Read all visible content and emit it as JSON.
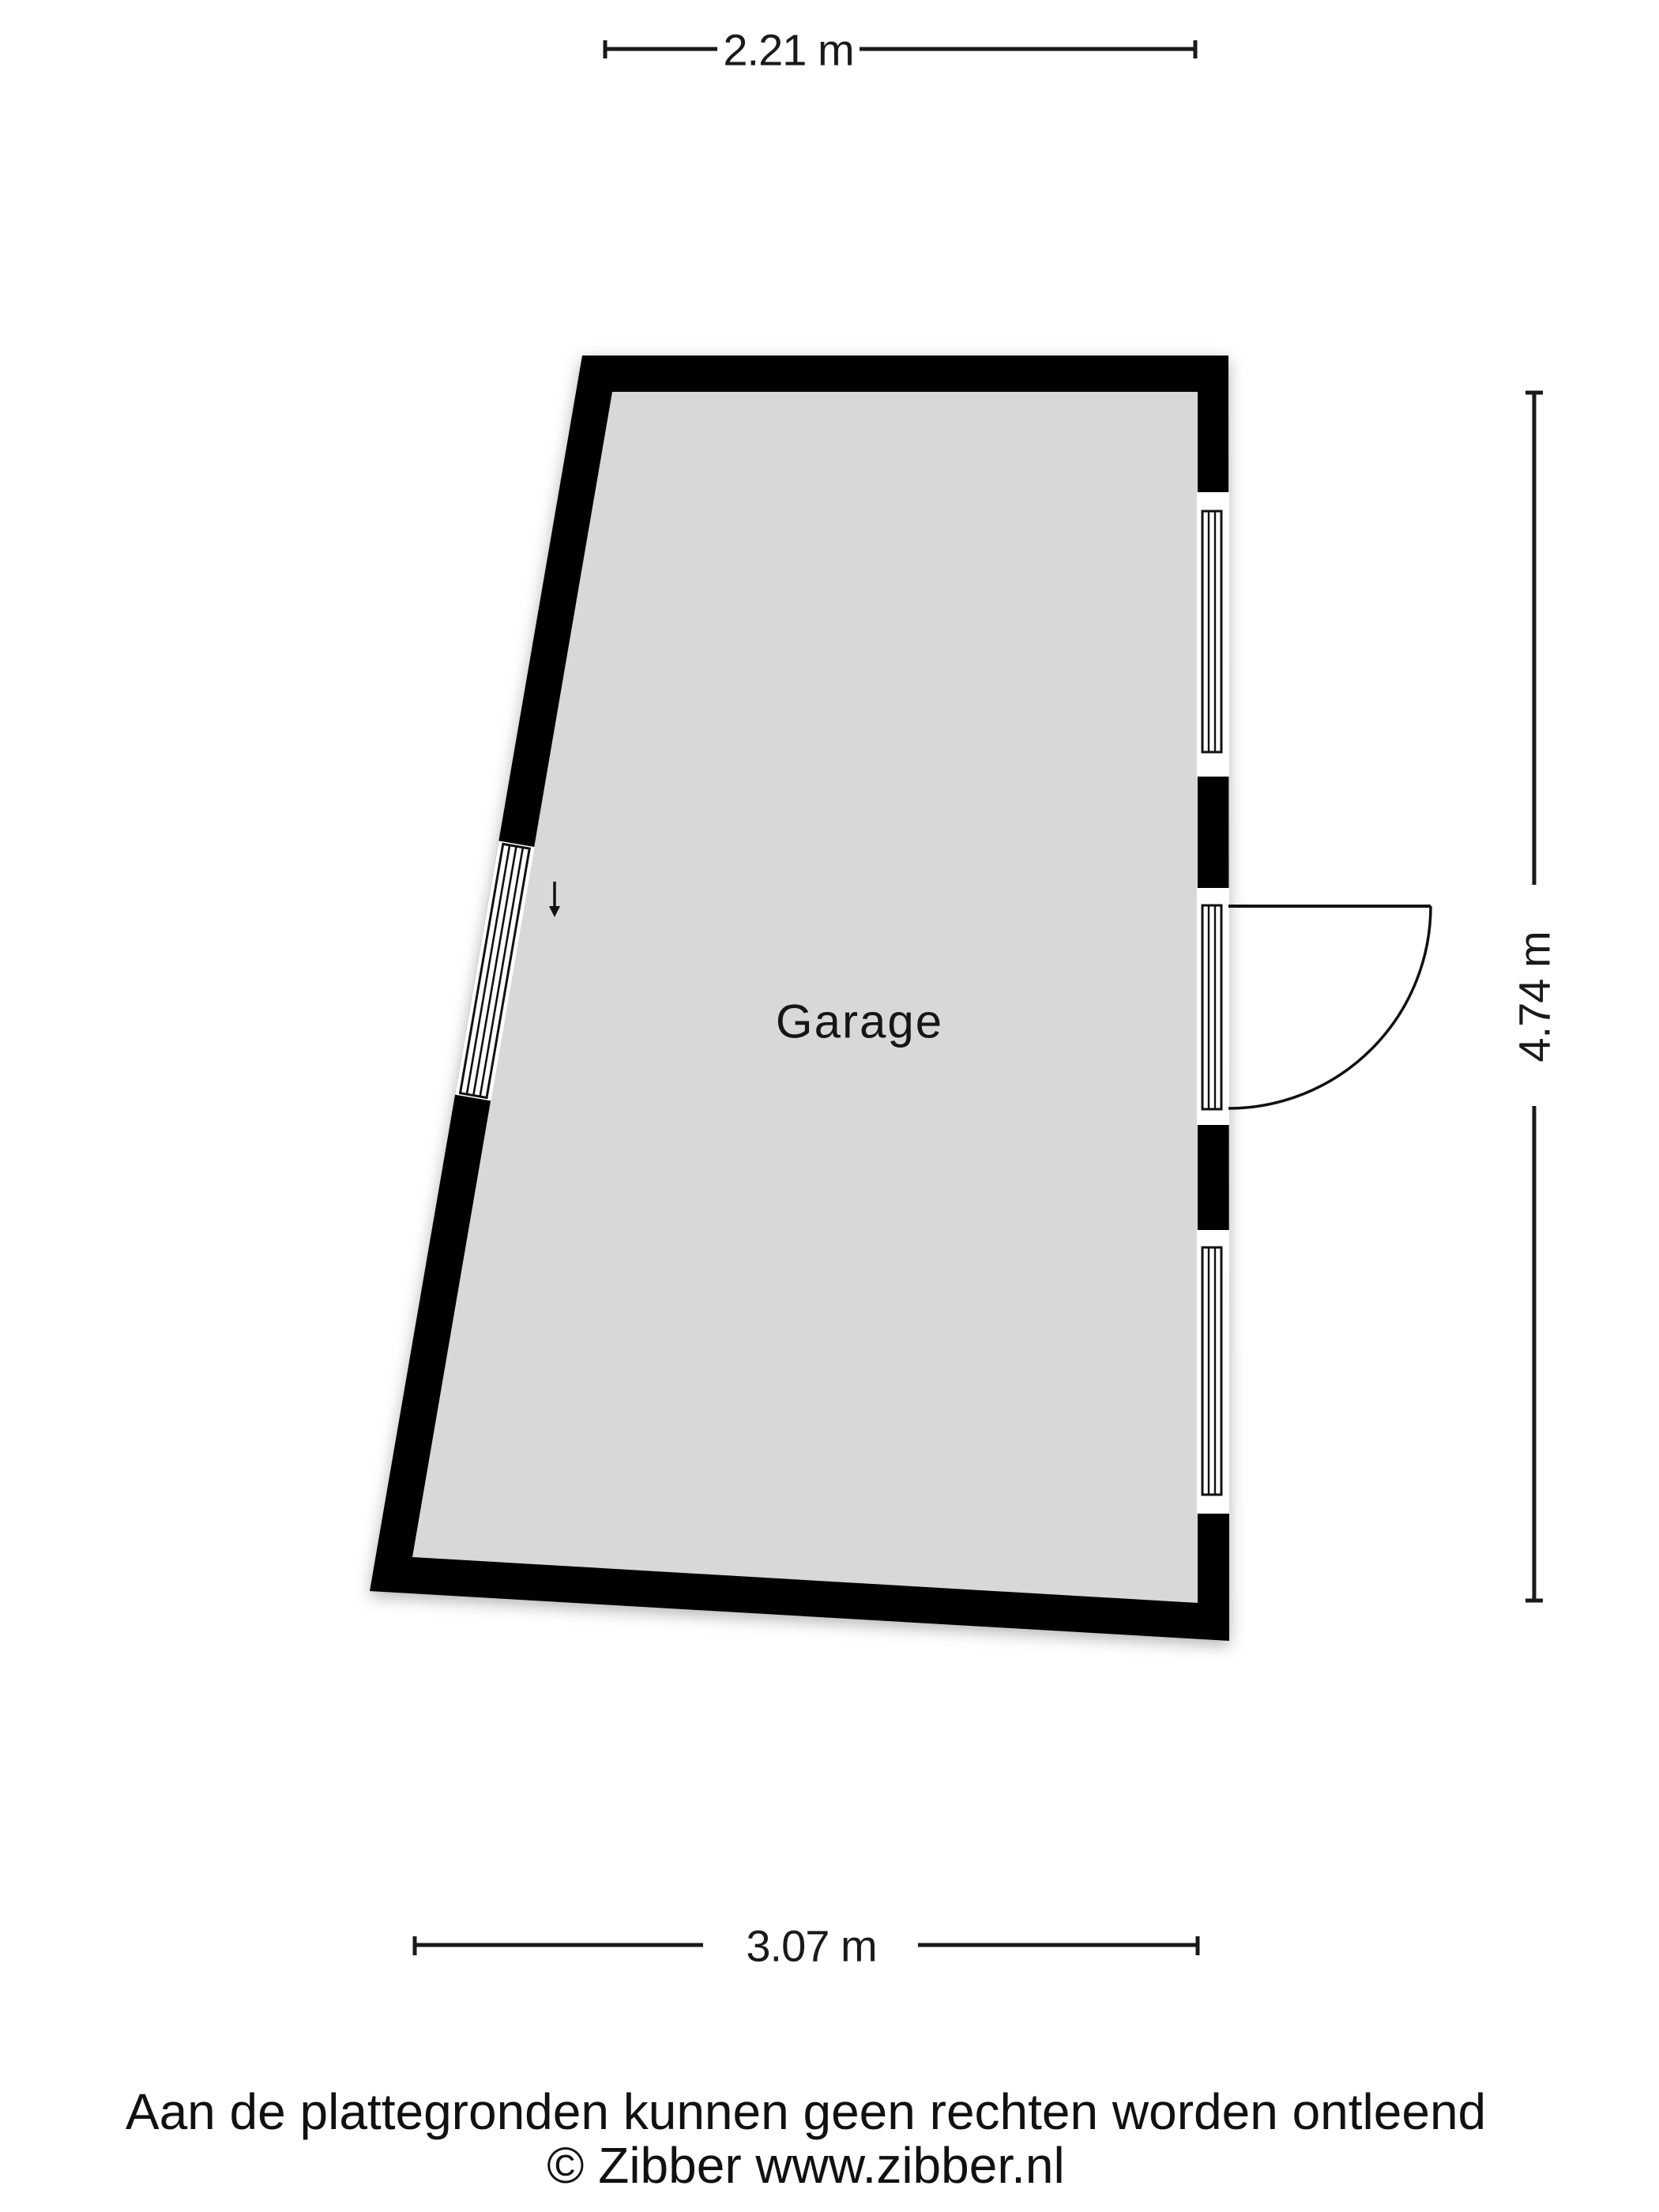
{
  "plan": {
    "room_label": "Garage",
    "colors": {
      "wall": "#000000",
      "floor": "#d8d8d8",
      "opening": "#ffffff",
      "line": "#1a1a1a",
      "glass_frame": "#111111"
    }
  },
  "dimensions": {
    "top": {
      "label": "2.21 m"
    },
    "right": {
      "label": "4.74 m"
    },
    "bottom": {
      "label": "3.07 m"
    }
  },
  "footer": {
    "disclaimer": "Aan de plattegronden kunnen geen rechten worden ontleend",
    "copyright": "© Zibber www.zibber.nl"
  }
}
